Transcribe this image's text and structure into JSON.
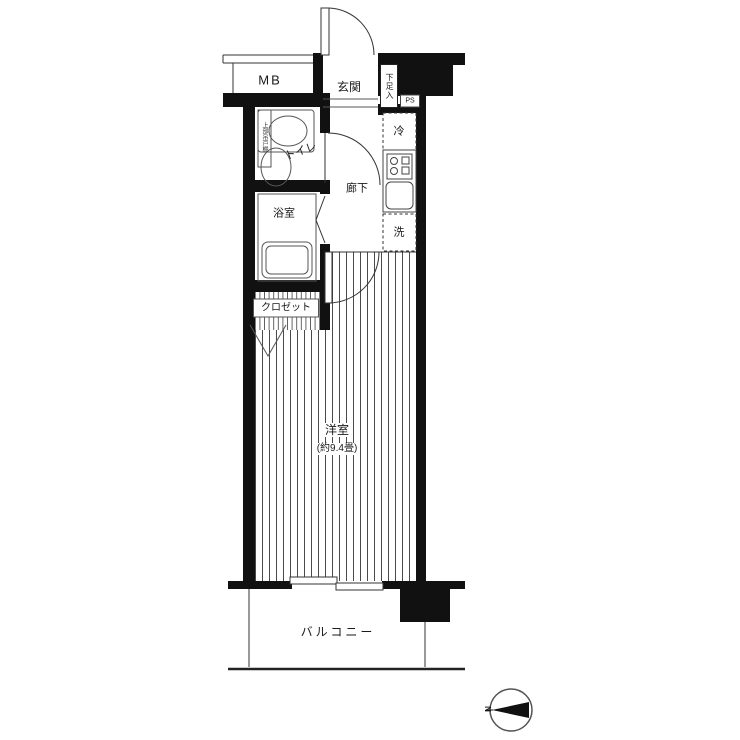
{
  "plan": {
    "upper": {
      "mb": "MB",
      "entrance": "玄関",
      "shoe_storage": "下足入",
      "pipe_shaft": "PS"
    },
    "water_area": {
      "toilet": "トイレ",
      "toilet_cabinet": "上部吊戸棚",
      "hallway": "廊下",
      "bathroom": "浴室",
      "refrigerator": "冷",
      "washing_machine": "洗",
      "closet": "クロゼット"
    },
    "main_room": {
      "name": "洋室",
      "size": "(約9.4畳)"
    },
    "outdoor": {
      "balcony": "バルコニー"
    },
    "compass": {
      "north": "N"
    },
    "colors": {
      "wall": "#111111",
      "thin_line": "#333333",
      "floor_stripe": "#4a4a4a",
      "background": "#ffffff"
    }
  }
}
